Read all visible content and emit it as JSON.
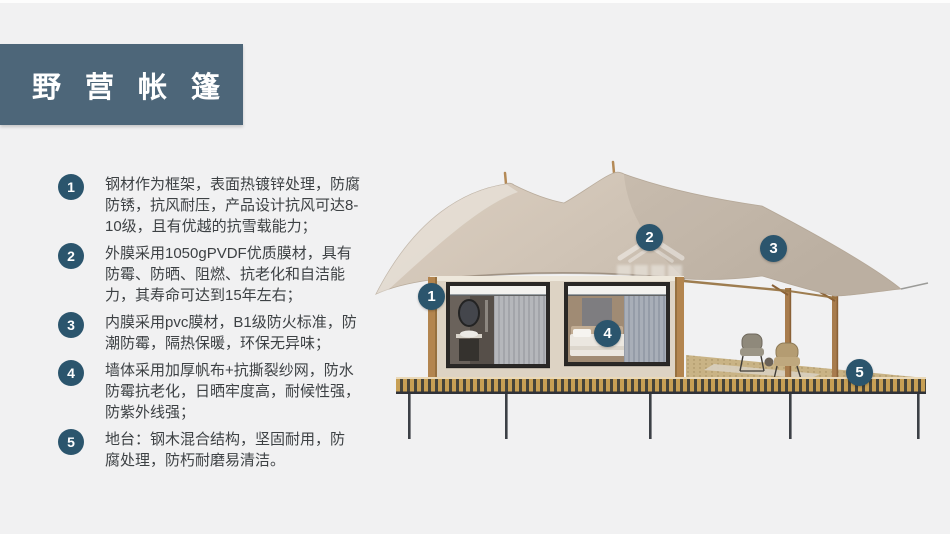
{
  "header": {
    "title": "野营帐篷"
  },
  "features": [
    {
      "num": "1",
      "text": "钢材作为框架，表面热镀锌处理，防腐\n防锈，抗风耐压，产品设计抗风可达8-\n10级，且有优越的抗雪载能力；"
    },
    {
      "num": "2",
      "text": "外膜采用1050gPVDF优质膜材，具有\n防霉、防晒、阻燃、抗老化和自洁能\n力，其寿命可达到15年左右；"
    },
    {
      "num": "3",
      "text": "内膜采用pvc膜材，B1级防火标准，防\n潮防霉，隔热保暖，环保无异味；"
    },
    {
      "num": "4",
      "text": "墙体采用加厚帆布+抗撕裂纱网，防水\n防霉抗老化，日晒牢度高，耐候性强，\n防紫外线强；"
    },
    {
      "num": "5",
      "text": "地台：钢木混合结构，坚固耐用，防\n腐处理，防朽耐磨易清洁。"
    }
  ],
  "callouts": [
    {
      "label": "1"
    },
    {
      "label": "2"
    },
    {
      "label": "3"
    },
    {
      "label": "4"
    },
    {
      "label": "5"
    }
  ],
  "colors": {
    "title_bg": "#4d6679",
    "badge": "#2b556d",
    "canopy": "#d0c4b6",
    "cabin_wall": "#ddd3c4",
    "deck_gold": "#c79f54",
    "page_bg": "#f1f1f2"
  }
}
